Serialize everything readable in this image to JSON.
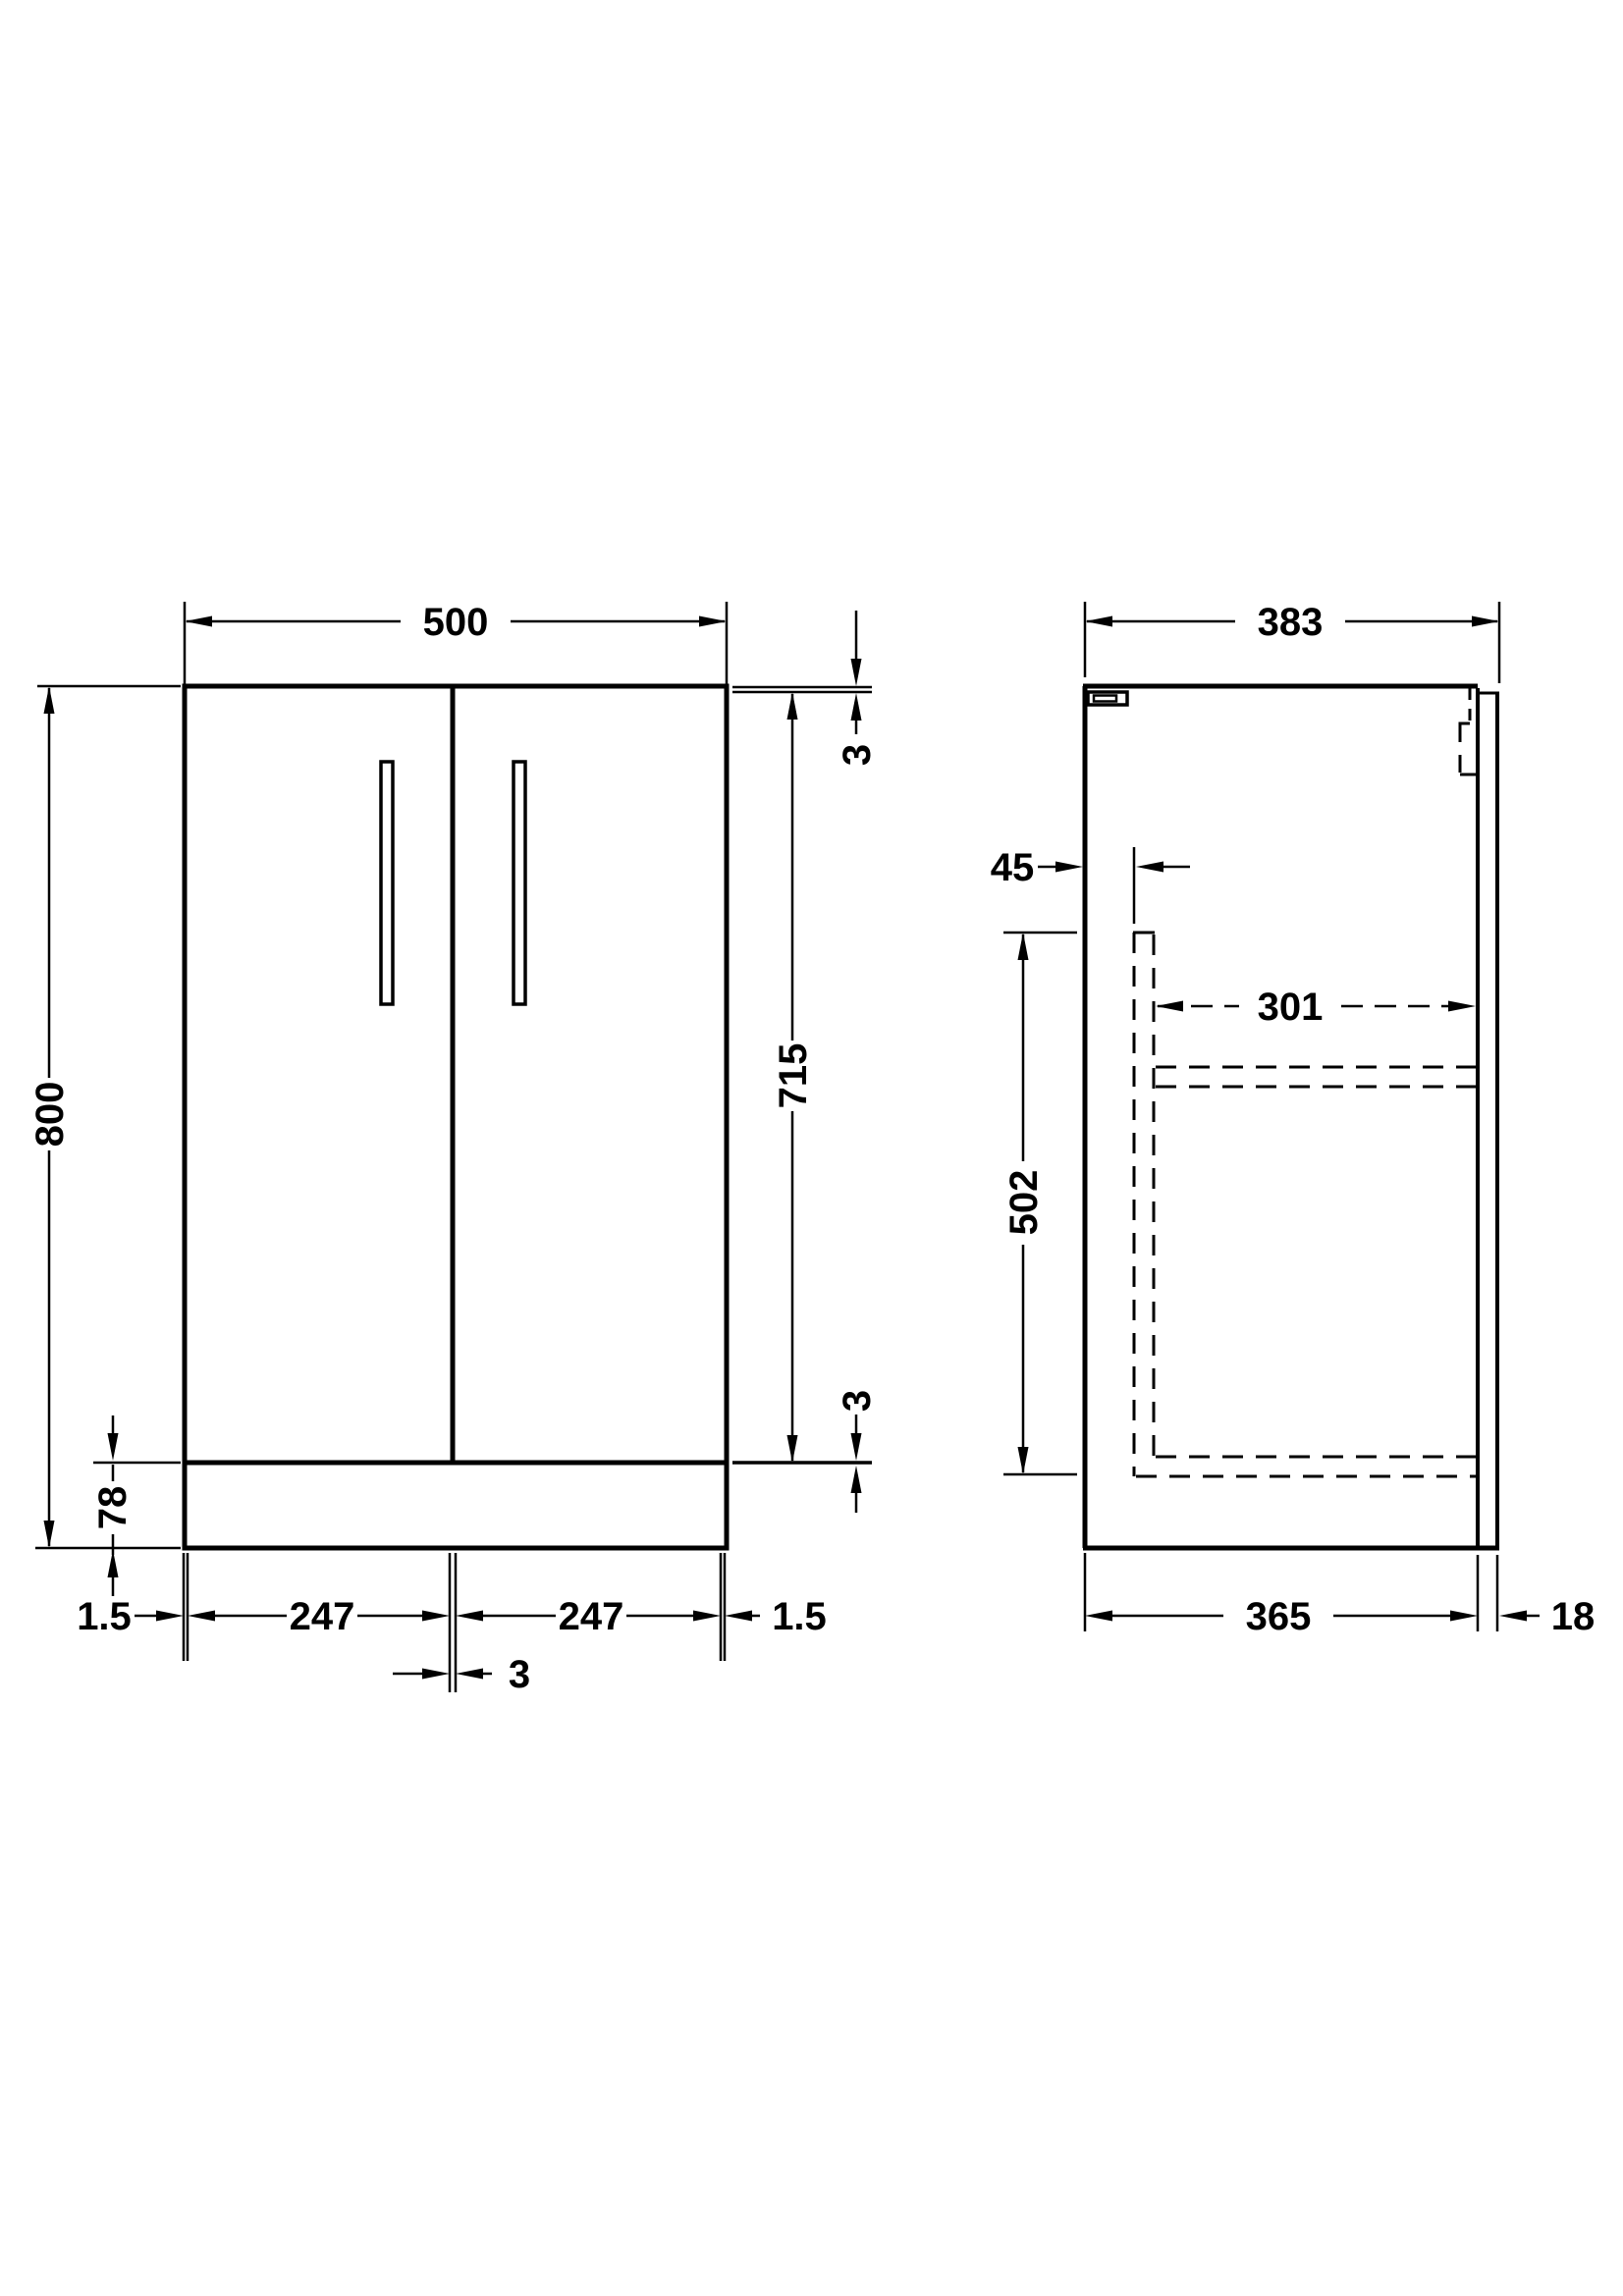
{
  "drawing": {
    "type": "technical-dimension-drawing",
    "subject": "vanity-unit-cabinet",
    "colors": {
      "line": "#000000",
      "background": "#ffffff"
    },
    "front_view": {
      "overall_width": "500",
      "overall_height": "800",
      "door_height": "715",
      "top_gap": "3",
      "bottom_gap": "3",
      "plinth_height": "78",
      "left_edge_gap": "1.5",
      "left_door_width": "247",
      "right_door_width": "247",
      "right_edge_gap": "1.5",
      "center_door_gap": "3"
    },
    "side_view": {
      "overall_depth": "383",
      "door_inset": "45",
      "interior_depth": "301",
      "interior_height": "502",
      "carcass_depth": "365",
      "back_panel_thickness": "18"
    }
  }
}
